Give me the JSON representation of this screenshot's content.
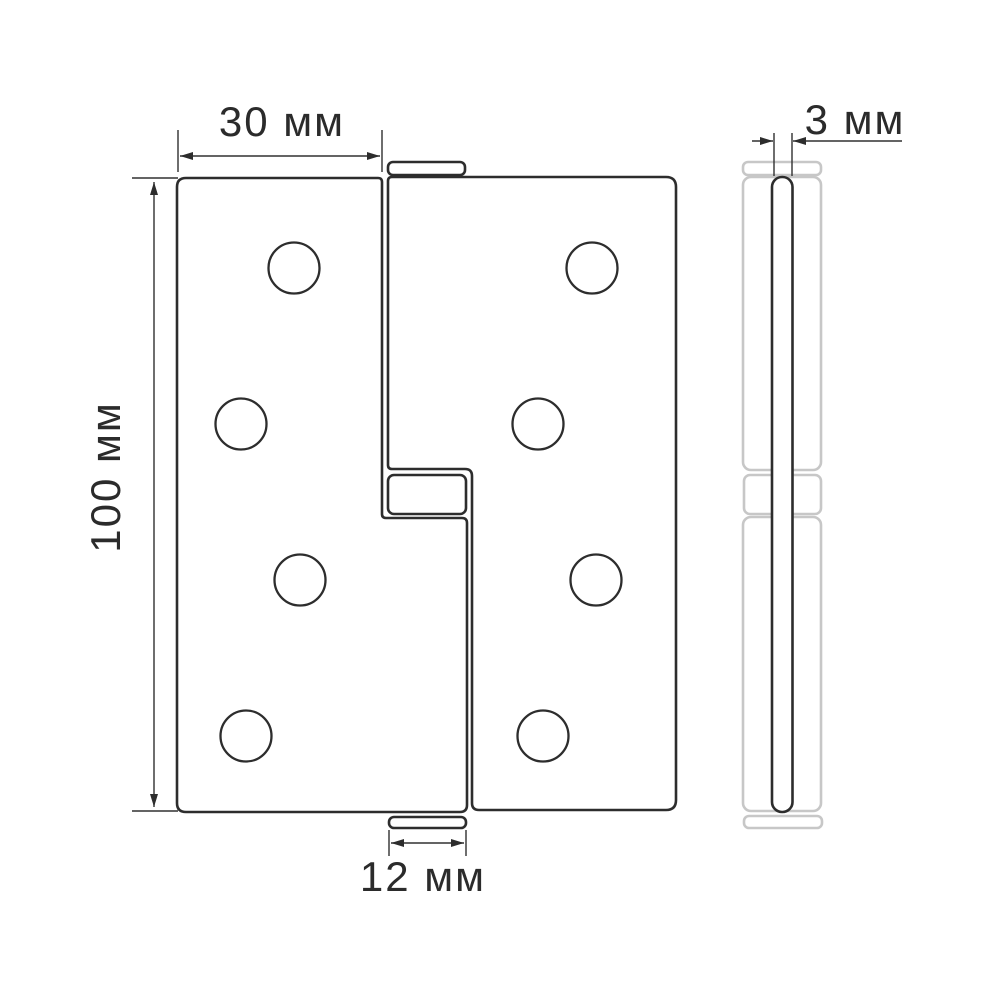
{
  "drawing": {
    "type": "technical-dimension-drawing",
    "subject": "lift-off door hinge, front view and side view",
    "colors": {
      "line": "#2d2d2d",
      "dimension_line": "#303030",
      "muted_outline": "#c7c7c7",
      "text": "#2b2b2b",
      "background": "#ffffff"
    },
    "dimensions": {
      "plate_width": {
        "label": "30 мм",
        "value": 30,
        "unit": "мм"
      },
      "height": {
        "label": "100 мм",
        "value": 100,
        "unit": "мм"
      },
      "knuckle_width": {
        "label": "12 мм",
        "value": 12,
        "unit": "мм"
      },
      "thickness": {
        "label": "3 мм",
        "value": 3,
        "unit": "мм"
      }
    }
  }
}
